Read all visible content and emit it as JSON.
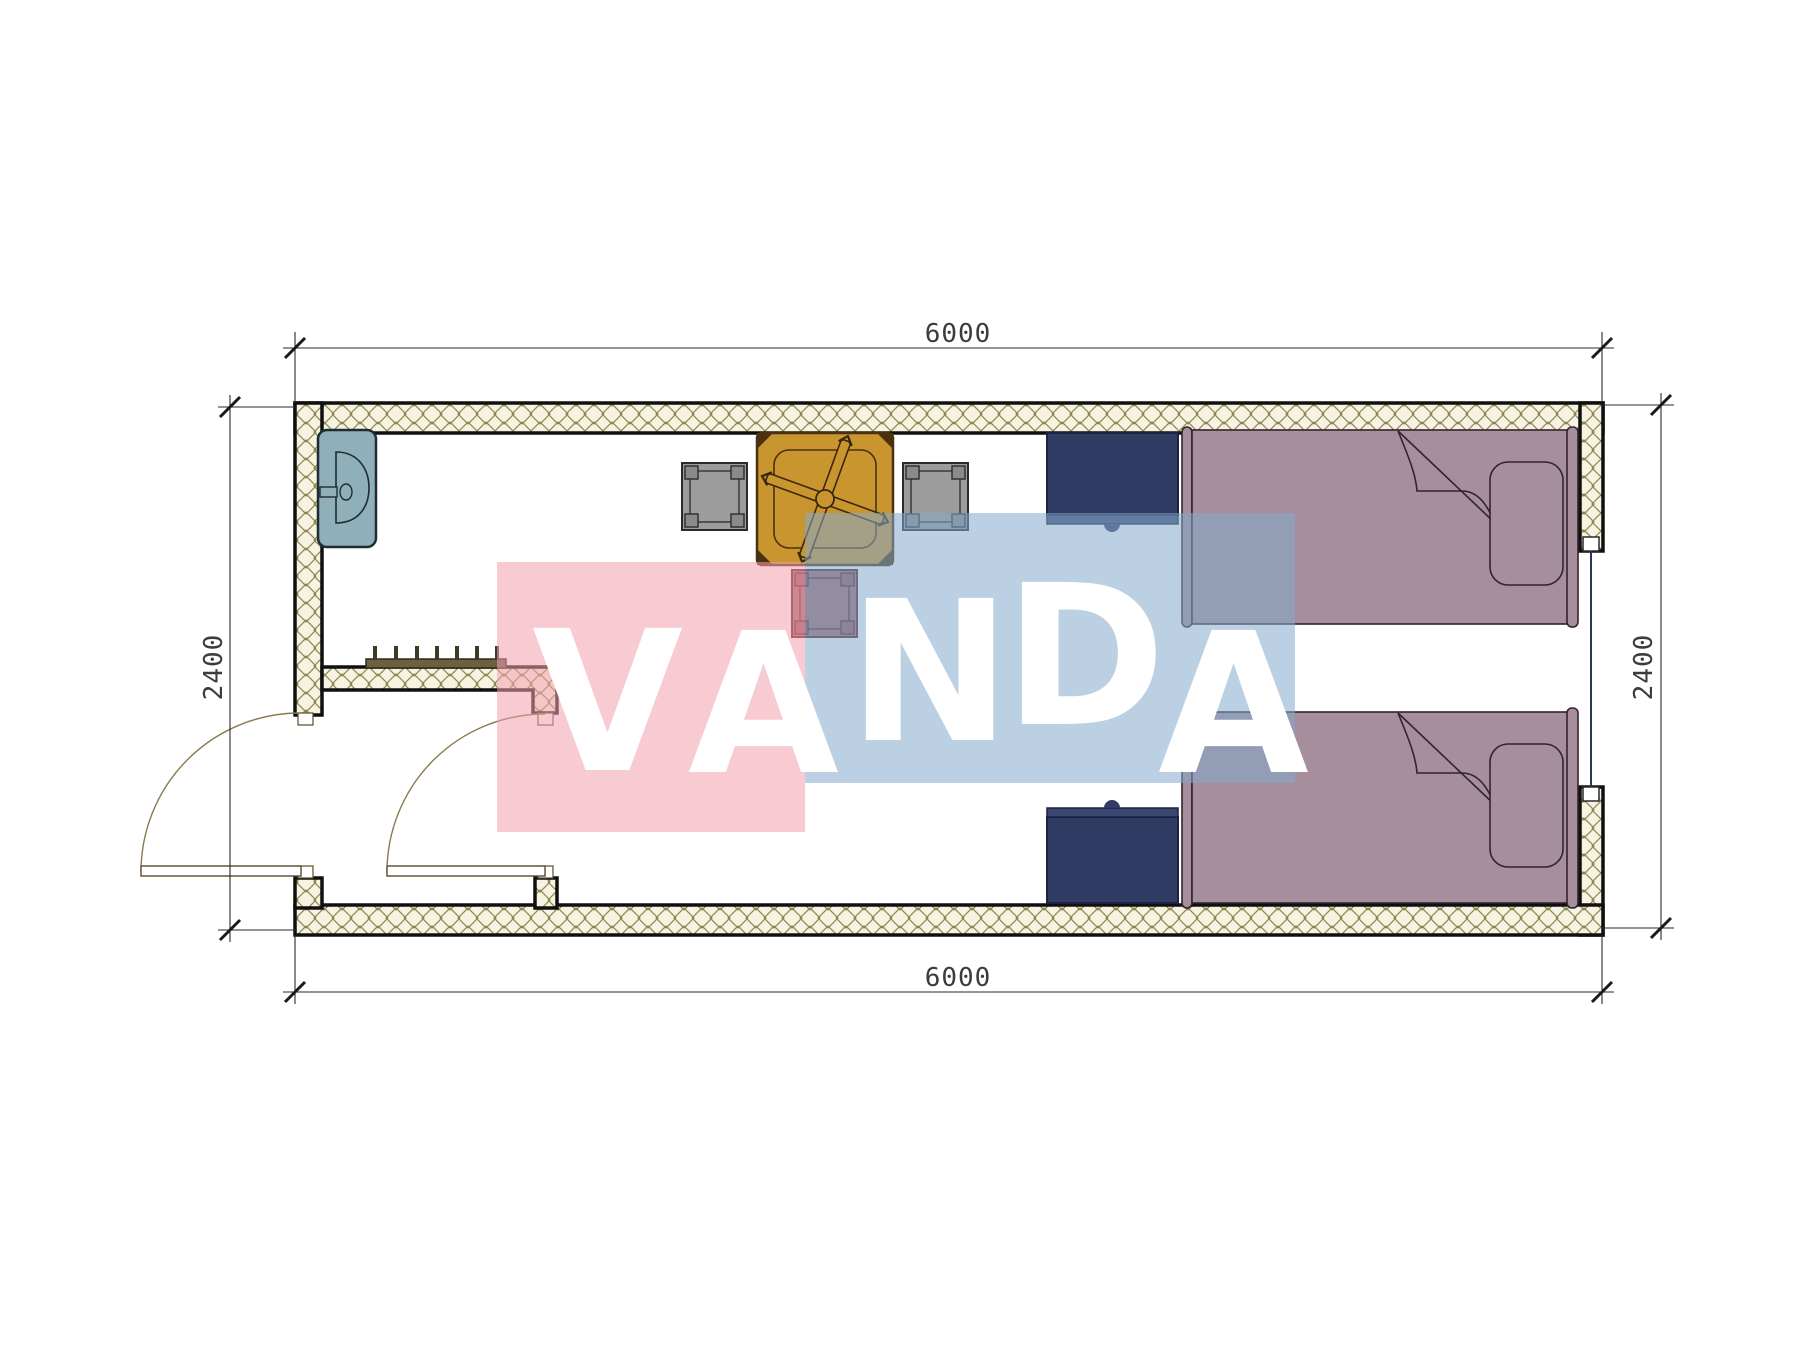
{
  "dimensions": {
    "top": "6000",
    "bottom": "6000",
    "left": "2400",
    "right": "2400"
  },
  "watermark": {
    "word": "VANDA",
    "letters": [
      "V",
      "A",
      "N",
      "D",
      "A"
    ],
    "pink_color": "#f3a0af",
    "blue_color": "#85a9cc",
    "text_color": "#ffffff"
  },
  "plan": {
    "wall": {
      "hatch_background": "#f6f3e3",
      "hatch_line_color": "#8f854f",
      "outline_color": "#101010"
    },
    "furniture": [
      {
        "name": "sink",
        "color": "#8fb0ba"
      },
      {
        "name": "coat-rack",
        "color": "#6b6140"
      },
      {
        "name": "entry-door-left",
        "color": "#8a7a50"
      },
      {
        "name": "entry-door-right",
        "color": "#8a7a50"
      },
      {
        "name": "table-with-fan",
        "color": "#c9952f"
      },
      {
        "name": "chair-left",
        "color": "#9c9c9c"
      },
      {
        "name": "chair-right",
        "color": "#9c9c9c"
      },
      {
        "name": "side-table",
        "color": "#a26a70"
      },
      {
        "name": "nightstand-top",
        "color": "#303b64"
      },
      {
        "name": "nightstand-bottom",
        "color": "#303b64"
      },
      {
        "name": "bed-top",
        "color": "#a68e9c"
      },
      {
        "name": "bed-bottom",
        "color": "#a68e9c"
      },
      {
        "name": "window-right",
        "color": "#2a3560"
      }
    ]
  }
}
